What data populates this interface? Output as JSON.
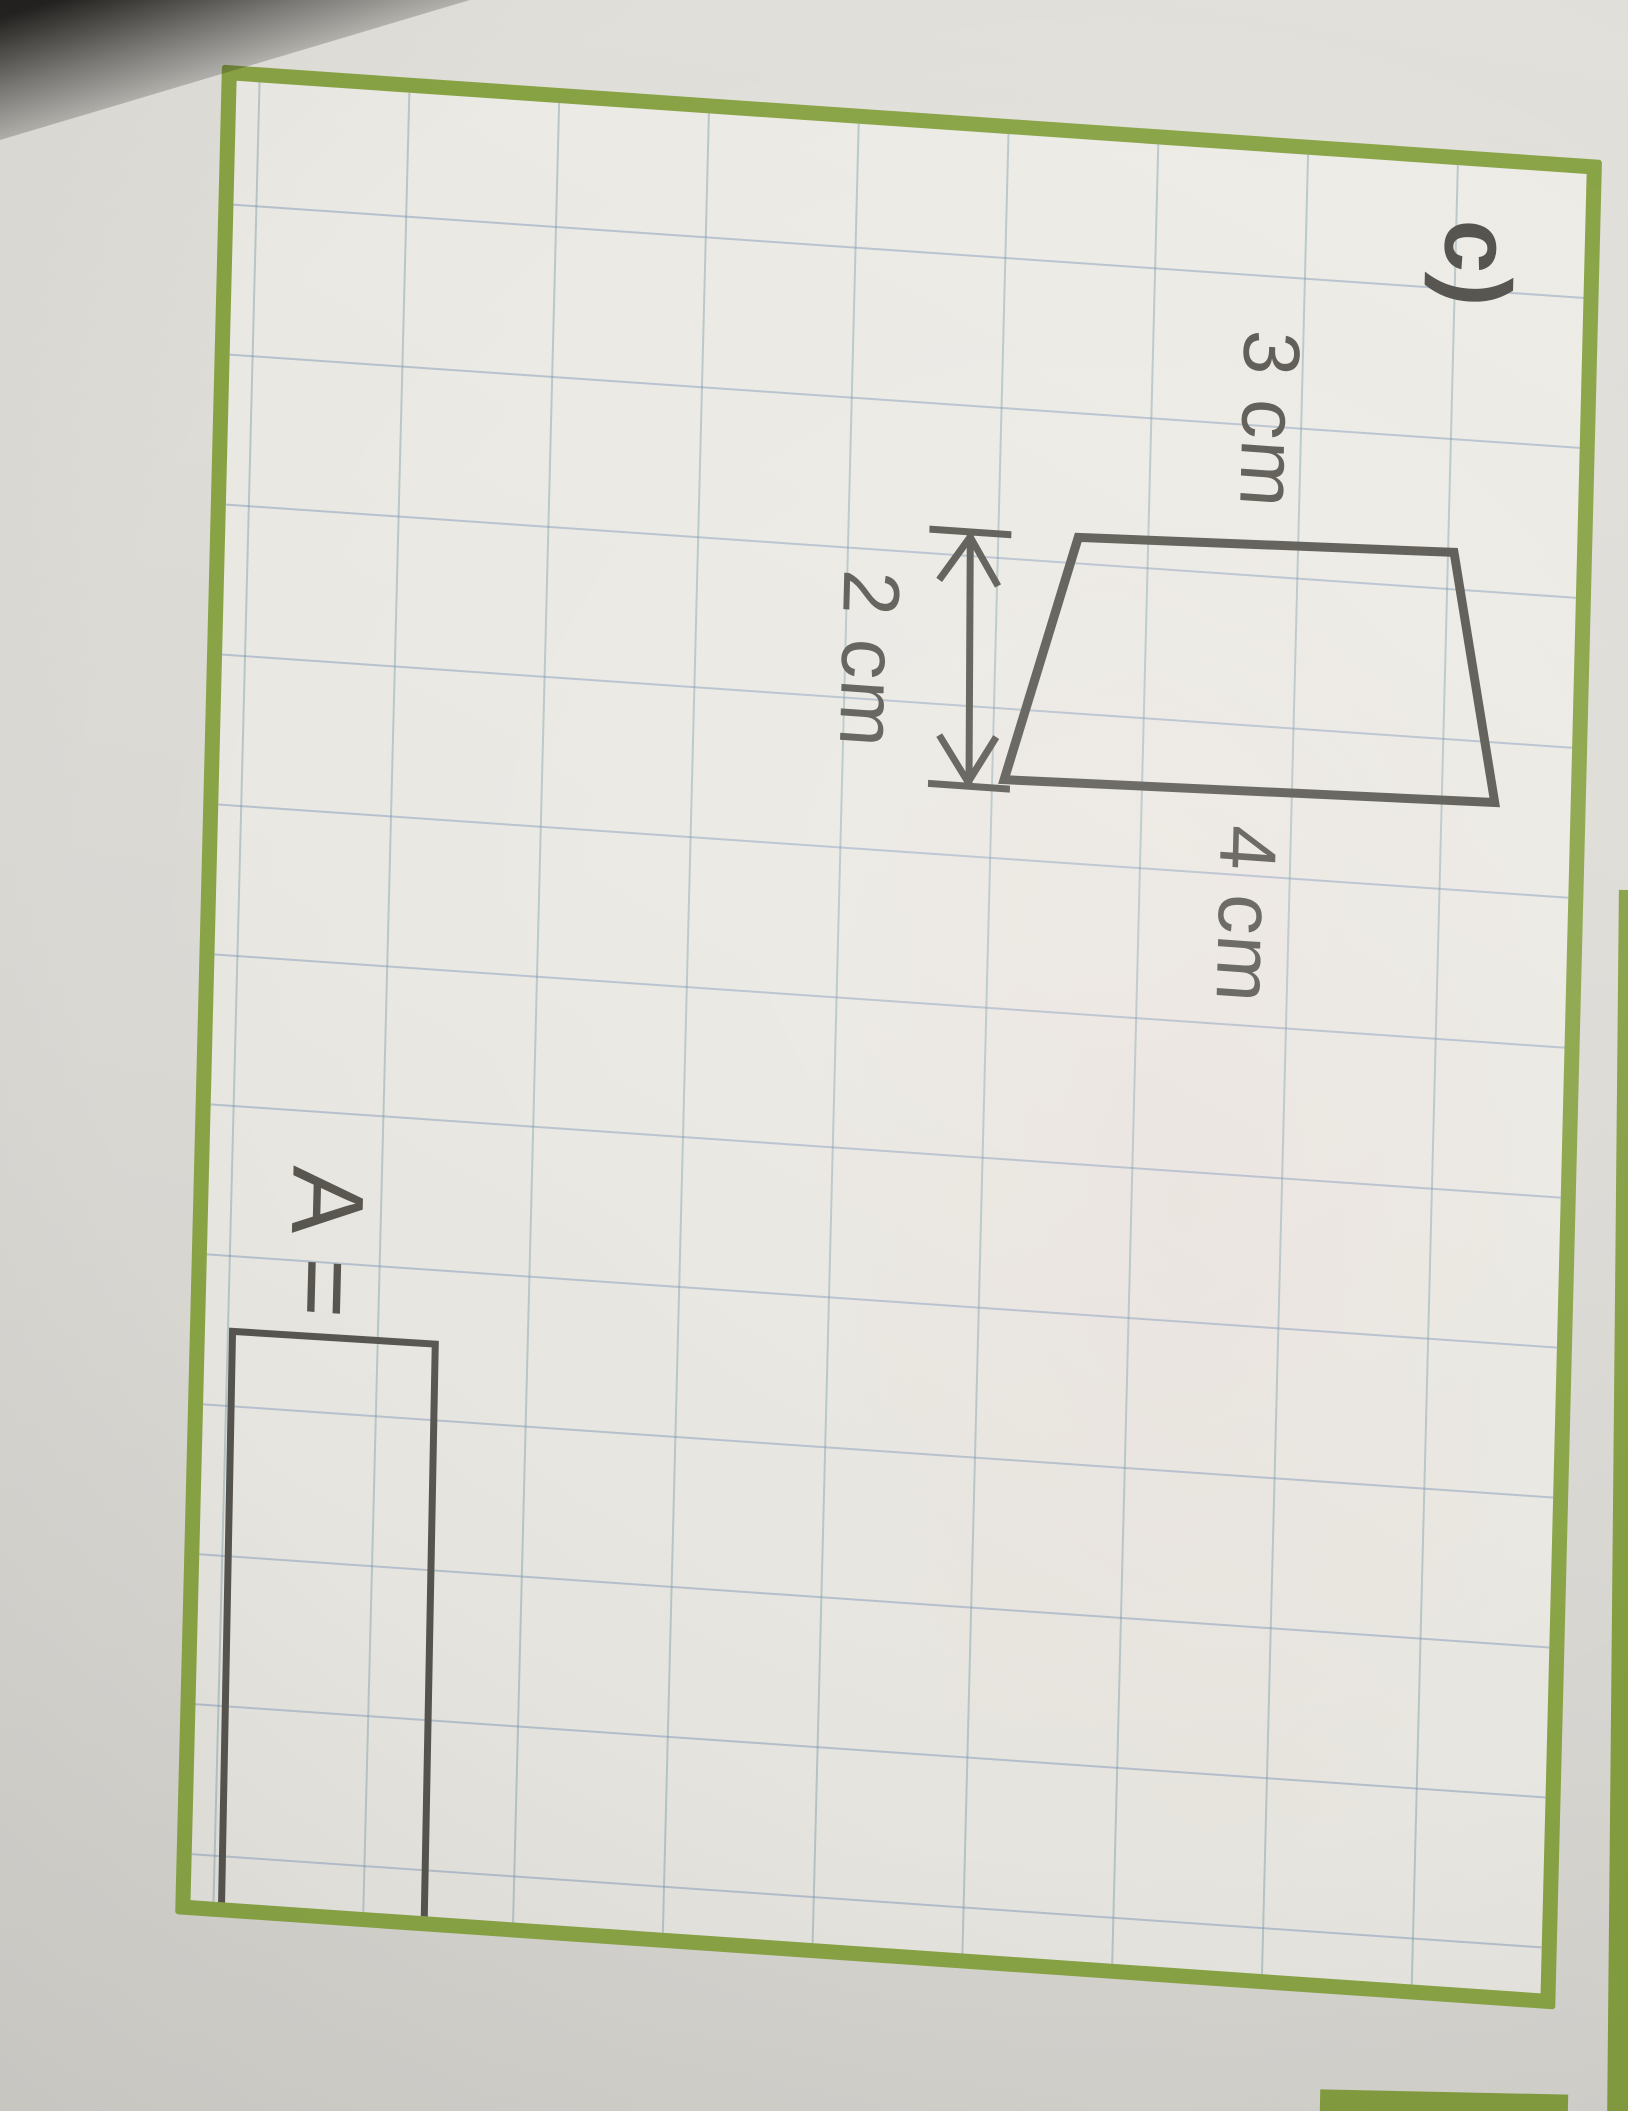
{
  "worksheet": {
    "exercise_label": "c)",
    "figure": {
      "shape": "trapezoid",
      "labels": {
        "left_side": "3 cm",
        "right_side": "4 cm",
        "width": "2 cm"
      }
    },
    "answer": {
      "label": "A =",
      "value": ""
    },
    "colors": {
      "frame_green": "#87a243",
      "ink": "#54524b",
      "grid_line": "#7e9cbd",
      "paper": "#e9e7e1",
      "margin_paper": "#d9d7d2"
    }
  }
}
